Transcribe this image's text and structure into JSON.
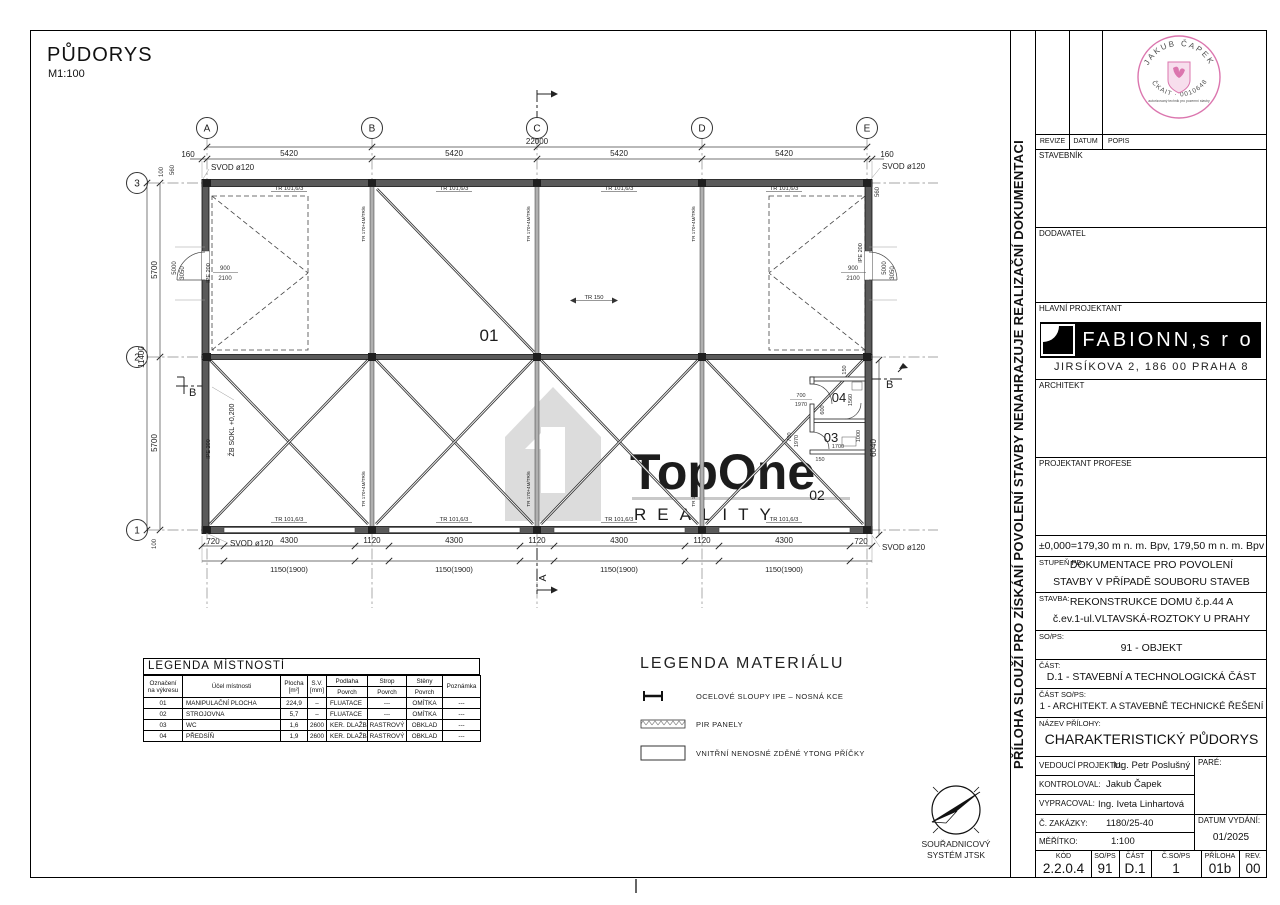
{
  "page": {
    "title": "PŮDORYS",
    "scale": "M1:100"
  },
  "plan": {
    "cols": [
      "A",
      "B",
      "C",
      "D",
      "E"
    ],
    "rows": [
      "3",
      "2",
      "1"
    ],
    "total_width": "22000",
    "top": [
      "160",
      "5420",
      "5420",
      "5420",
      "5420",
      "160"
    ],
    "bottom": [
      "720",
      "4300",
      "1120",
      "4300",
      "1120",
      "4300",
      "1120",
      "4300",
      "720"
    ],
    "bottom2": "1150(1900)",
    "left_total": "11400",
    "left": [
      "100",
      "560",
      "5700",
      "5700",
      "100"
    ],
    "right_560": "560",
    "right_6040": "6040",
    "d5000": "5000",
    "d3050": "3050",
    "door_w": "900",
    "door_h": "2100",
    "svod": "SVOD ø120",
    "tube": "TR 101,6/3",
    "tr150": "TR 150",
    "ipe": "IPE 200",
    "brace": "TR 170+4M/TR/6",
    "sokl": "ŽB SOKL +0,200",
    "r01": "01",
    "r02": "02",
    "r03": "03",
    "r04": "04",
    "sa": "A",
    "sb": "B",
    "small": {
      "d150": "150",
      "d700": "700",
      "d1970": "1970",
      "d600": "600",
      "d1700": "1700",
      "d1000": "1000",
      "d1560": "1560"
    }
  },
  "legend_rooms": {
    "title": "LEGENDA MÍSTNOSTÍ",
    "h_ozn1": "Označení",
    "h_ozn2": "na výkresu",
    "h_ucel": "Účel místnosti",
    "h_plocha1": "Plocha",
    "h_plocha2": "[m²]",
    "h_sv1": "S.V.",
    "h_sv2": "[mm]",
    "h_podlaha": "Podlaha",
    "h_strop": "Strop",
    "h_steny": "Stěny",
    "h_povrch": "Povrch",
    "h_pozn": "Poznámka",
    "rows": [
      [
        "01",
        "MANIPULAČNÍ PLOCHA",
        "224,9",
        "–",
        "FLUATACE",
        "---",
        "OMÍTKA",
        "---"
      ],
      [
        "02",
        "STROJOVNA",
        "5,7",
        "–",
        "FLUATACE",
        "---",
        "OMÍTKA",
        "---"
      ],
      [
        "03",
        "WC",
        "1,6",
        "2600",
        "KER. DLAŽBA",
        "RASTROVÝ",
        "OBKLAD",
        "---"
      ],
      [
        "04",
        "PŘEDSÍŇ",
        "1,9",
        "2600",
        "KER. DLAŽBA",
        "RASTROVÝ",
        "OBKLAD",
        "---"
      ]
    ]
  },
  "legend_mat": {
    "title": "LEGENDA MATERIÁLU",
    "i1": "OCELOVÉ SLOUPY IPE – NOSNÁ KCE",
    "i2": "PIR PANELY",
    "i3": "VNITŘNÍ NENOSNÉ ZDĚNÉ YTONG PŘÍČKY"
  },
  "north": {
    "l1": "SOUŘADNICOVÝ",
    "l2": "SYSTÉM JTSK"
  },
  "watermark": {
    "top": "TopOne",
    "bottom": "REALITY"
  },
  "note_vertical": "PŘÍLOHA SLOUŽÍ PRO ZÍSKÁNÍ POVOLENÍ STAVBY  NENAHRAZUJE REALIZAČNÍ DOKUMENTACI",
  "stamp": {
    "arc_top": "JAKUB ČAPEK",
    "arc_bottom": "ČKAIT · 0010648",
    "middle": "autorizovaný technik pro pozemní stavby"
  },
  "tb": {
    "revize": "REVIZE",
    "datum": "DATUM",
    "popis": "POPIS",
    "stavebnik": "STAVEBNÍK",
    "dodavatel": "DODAVATEL",
    "hlavni": "HLAVNÍ PROJEKTANT",
    "logo": "FABIONN,s r o",
    "logo_addr": "JIRSÍKOVA 2, 186 00 PRAHA 8",
    "architekt": "ARCHITEKT",
    "profese": "PROJEKTANT PROFESE",
    "elevation": "±0,000=179,30 m n. m. Bpv, 179,50 m n. m. Bpv",
    "stupen_l": "STUPEŇ PD:",
    "stupen_1": "DOKUMENTACE PRO POVOLENÍ",
    "stupen_2": "STAVBY V PŘÍPADĚ SOUBORU STAVEB",
    "stavba_l": "STAVBA:",
    "stavba_1": "REKONSTRUKCE DOMU č.p.44 A",
    "stavba_2": "č.ev.1-ul.VLTAVSKÁ-ROZTOKY U PRAHY",
    "sops_l": "SO/PS:",
    "sops_v": "91 - OBJEKT",
    "cast_l": "ČÁST:",
    "cast_v": "D.1 - STAVEBNÍ A TECHNOLOGICKÁ ČÁST",
    "castso_l": "ČÁST SO/PS:",
    "castso_v": "1 - ARCHITEKT. A STAVEBNĚ TECHNICKÉ ŘEŠENÍ",
    "nazev_l": "NÁZEV PŘÍLOHY:",
    "nazev_v": "CHARAKTERISTICKÝ PŮDORYS",
    "vedouci_l": "VEDOUCÍ PROJEKTU:",
    "vedouci_v": "Ing. Petr Poslušný",
    "pare": "PARÉ:",
    "kontroloval_l": "KONTROLOVAL:",
    "kontroloval_v": "Jakub Čapek",
    "vypracoval_l": "VYPRACOVAL:",
    "vypracoval_v": "Ing. Iveta Linhartová",
    "zakazka_l": "Č. ZAKÁZKY:",
    "zakazka_v": "1180/25-40",
    "meritko_l": "MĚŘÍTKO:",
    "meritko_v": "1:100",
    "datumv_l": "DATUM VYDÁNÍ:",
    "datumv_v": "01/2025",
    "codes": [
      {
        "h": "KÓD",
        "v": "2.2.0.4"
      },
      {
        "h": "SO/PS",
        "v": "91"
      },
      {
        "h": "ČÁST",
        "v": "D.1"
      },
      {
        "h": "Č.SO/PS",
        "v": "1"
      },
      {
        "h": "PŘÍLOHA",
        "v": "01b"
      },
      {
        "h": "REV.",
        "v": "00"
      }
    ]
  }
}
